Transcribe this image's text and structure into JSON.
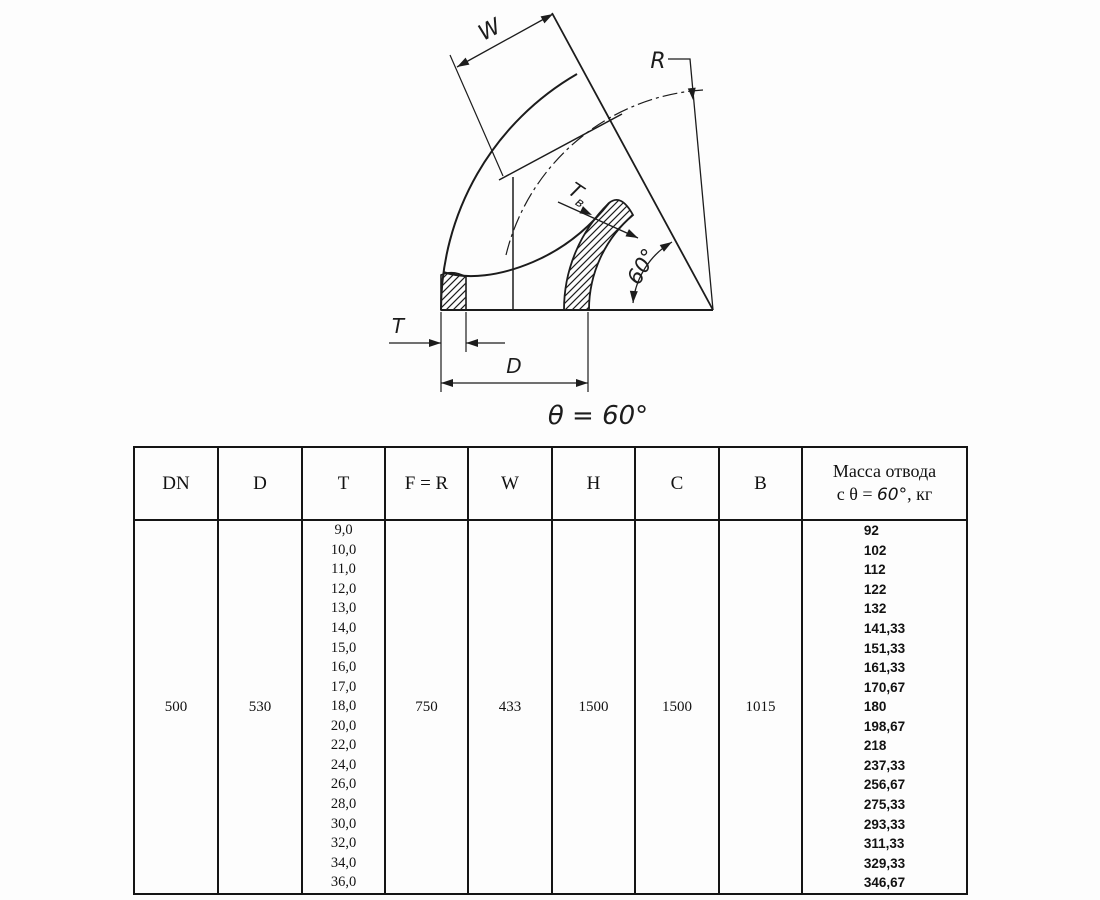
{
  "drawing": {
    "labels": {
      "w": "W",
      "r": "R",
      "t": "T",
      "d": "D",
      "t_inner_main": "T",
      "t_inner_sub": "в",
      "angle": "60°",
      "caption": "θ = 60°"
    },
    "line_color": "#1c1c1c"
  },
  "table": {
    "headers": [
      "DN",
      "D",
      "T",
      "F = R",
      "W",
      "H",
      "C",
      "B"
    ],
    "mass_header": {
      "line1": "Масса отвода",
      "line2_prefix": "с θ = ",
      "line2_angle": "60°",
      "line2_suffix": ", кг"
    },
    "row": {
      "dn": "500",
      "d": "530",
      "f_r": "750",
      "w": "433",
      "h": "1500",
      "c": "1500",
      "b": "1015"
    },
    "t_values": [
      "9,0",
      "10,0",
      "11,0",
      "12,0",
      "13,0",
      "14,0",
      "15,0",
      "16,0",
      "17,0",
      "18,0",
      "20,0",
      "22,0",
      "24,0",
      "26,0",
      "28,0",
      "30,0",
      "32,0",
      "34,0",
      "36,0"
    ],
    "mass_values": [
      "92",
      "102",
      "112",
      "122",
      "132",
      "141,33",
      "151,33",
      "161,33",
      "170,67",
      "180",
      "198,67",
      "218",
      "237,33",
      "256,67",
      "275,33",
      "293,33",
      "311,33",
      "329,33",
      "346,67"
    ]
  }
}
